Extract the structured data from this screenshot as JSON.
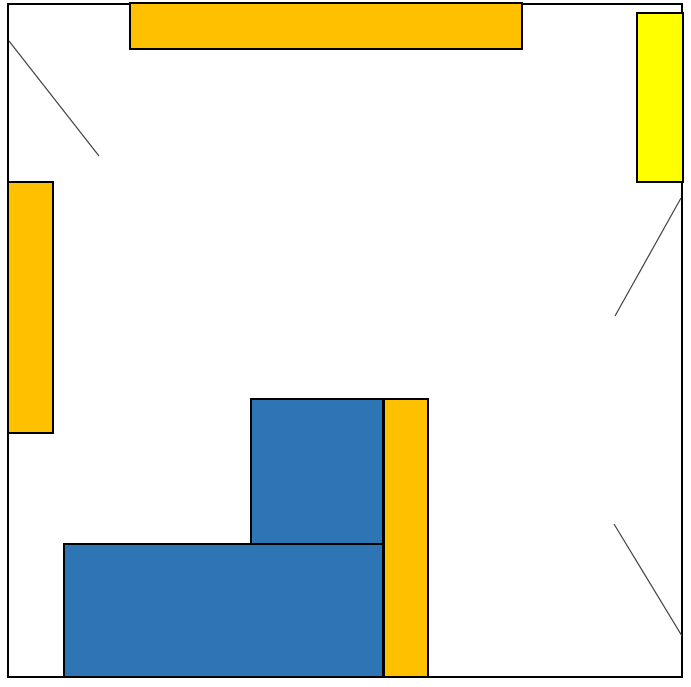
{
  "canvas": {
    "width": 691,
    "height": 687,
    "background_color": "#ffffff",
    "description": "Floor-plan style line drawing: square room outline containing colored rectangles and three thin diagonal lines"
  },
  "outer_frame": {
    "name": "room-outline",
    "x": 7,
    "y": 3,
    "w": 676,
    "h": 675,
    "stroke": "#000000",
    "stroke_width": 2
  },
  "shapes": [
    {
      "name": "top-horizontal-orange-bar",
      "x": 129,
      "y": 2,
      "w": 394,
      "h": 48,
      "fill": "#FFC000",
      "stroke": "#000000",
      "stroke_width": 2.5
    },
    {
      "name": "top-right-yellow-rect",
      "x": 636,
      "y": 12,
      "w": 48,
      "h": 171,
      "fill": "#FFFF00",
      "stroke": "#000000",
      "stroke_width": 2.5
    },
    {
      "name": "left-vertical-orange-rect",
      "x": 7,
      "y": 181,
      "w": 47,
      "h": 253,
      "fill": "#FFC000",
      "stroke": "#000000",
      "stroke_width": 2.5
    },
    {
      "name": "upper-blue-rect",
      "x": 250,
      "y": 398,
      "w": 134,
      "h": 148,
      "fill": "#2E75B6",
      "stroke": "#000000",
      "stroke_width": 2.5
    },
    {
      "name": "lower-blue-rect",
      "x": 63,
      "y": 543,
      "w": 321,
      "h": 135,
      "fill": "#2E75B6",
      "stroke": "#000000",
      "stroke_width": 2.5
    },
    {
      "name": "right-vertical-orange-bar",
      "x": 383,
      "y": 398,
      "w": 46,
      "h": 280,
      "fill": "#FFC000",
      "stroke": "#000000",
      "stroke_width": 2.5
    }
  ],
  "lines": [
    {
      "name": "top-left-diagonal-line",
      "x1": 9,
      "y1": 41,
      "x2": 99,
      "y2": 156,
      "stroke": "#404040",
      "stroke_width": 1.2
    },
    {
      "name": "right-side-diagonal-line",
      "x1": 681,
      "y1": 198,
      "x2": 615,
      "y2": 316,
      "stroke": "#404040",
      "stroke_width": 1.2
    },
    {
      "name": "bottom-right-diagonal-line",
      "x1": 614,
      "y1": 524,
      "x2": 682,
      "y2": 636,
      "stroke": "#404040",
      "stroke_width": 1.2
    }
  ]
}
